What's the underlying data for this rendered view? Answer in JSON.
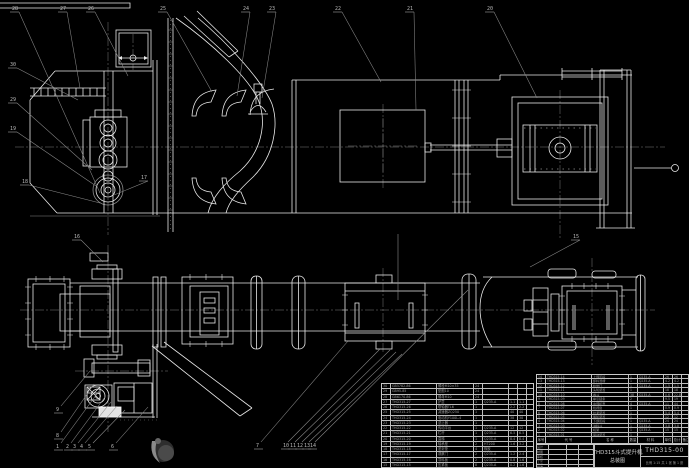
{
  "title_block": {
    "product": "THD315斗式提升机",
    "drawing_title": "总装图",
    "drawing_no": "THD315-00",
    "scale_note": "比例 1:15  共 1 张  第 1 张",
    "signature_labels": [
      "设计",
      "制图",
      "审核",
      "工艺",
      "批准"
    ]
  },
  "bom_header": [
    "序号",
    "代  号",
    "名  称",
    "数量",
    "材  料",
    "单件",
    "总计",
    "备注"
  ],
  "bom_left_rows": [
    [
      "30",
      "GB5782-86",
      "螺栓M10×35",
      "24",
      "",
      "",
      "",
      ""
    ],
    [
      "29",
      "GB95-85",
      "垫圈10",
      "24",
      "",
      "",
      "",
      ""
    ],
    [
      "28",
      "GB6170-86",
      "螺母M10",
      "24",
      "",
      "",
      "",
      ""
    ],
    [
      "27",
      "THD315-27",
      "护罩",
      "1",
      "Q235-A",
      "1.1",
      "1.1",
      ""
    ],
    [
      "26",
      "THD315-26",
      "联轴器TL6",
      "1",
      "",
      "2.2",
      "2.2",
      ""
    ],
    [
      "25",
      "THD315-25",
      "减速器ZQ250",
      "1",
      "",
      "40",
      "40",
      ""
    ],
    [
      "24",
      "THD315-24",
      "电动机Y100L-4",
      "1",
      "",
      "38",
      "38",
      ""
    ],
    [
      "23",
      "THD315-23",
      "逆止器",
      "1",
      "",
      "",
      "",
      ""
    ],
    [
      "22",
      "THD315-22",
      "传动平台",
      "1",
      "Q235-A",
      "12",
      "12",
      ""
    ],
    [
      "21",
      "THD315-21",
      "栏杆",
      "1",
      "Q235-A",
      "6.5",
      "6.5",
      ""
    ],
    [
      "20",
      "THD315-20",
      "直梯",
      "1",
      "Q235-A",
      "8.4",
      "8.4",
      ""
    ],
    [
      "19",
      "THD315-19",
      "轴承座",
      "2",
      "HT200",
      "1.6",
      "3.2",
      ""
    ],
    [
      "18",
      "THD315-18",
      "密封垫",
      "4",
      "橡胶",
      "",
      "",
      ""
    ],
    [
      "17",
      "THD315-17",
      "观察门",
      "2",
      "Q235-A",
      "1.2",
      "2.4",
      ""
    ],
    [
      "16",
      "THD315-16",
      "导料板",
      "2",
      "Q235-A",
      "0.8",
      "1.6",
      ""
    ],
    [
      "15",
      "THD315-15",
      "压紧板",
      "8",
      "Q235-A",
      "0.2",
      "1.6",
      ""
    ]
  ],
  "bom_right_rows": [
    [
      "14",
      "THD315-14",
      "上部区段",
      "1",
      "Q235-A",
      "26",
      "26",
      ""
    ],
    [
      "13",
      "THD315-13",
      "卸料溜槽",
      "1",
      "Q235-A",
      "4.2",
      "4.2",
      ""
    ],
    [
      "12",
      "THD315-12",
      "检修门",
      "1",
      "Q235-A",
      "1.5",
      "1.5",
      ""
    ],
    [
      "11",
      "THD315-11",
      "头轮装置",
      "1",
      "",
      "18",
      "18",
      ""
    ],
    [
      "10",
      "THD315-10",
      "畚斗",
      "38",
      "Q235-A",
      "0.6",
      "22.8",
      ""
    ],
    [
      "9",
      "THD315-09",
      "牵引链条",
      "2",
      "",
      "9.5",
      "19",
      ""
    ],
    [
      "8",
      "THD315-08",
      "中部机壳",
      "4",
      "Q235-A",
      "11",
      "44",
      ""
    ],
    [
      "7",
      "THD315-07",
      "检视窗",
      "1",
      "",
      "0.9",
      "0.9",
      ""
    ],
    [
      "6",
      "THD315-06",
      "拉紧装置",
      "1",
      "",
      "5.4",
      "5.4",
      ""
    ],
    [
      "5",
      "THD315-05",
      "尾轮装置",
      "1",
      "",
      "12",
      "12",
      ""
    ],
    [
      "4",
      "THD315-04",
      "下部区段",
      "1",
      "Q235-A",
      "24",
      "24",
      ""
    ],
    [
      "3",
      "THD315-03",
      "进料斗",
      "1",
      "Q235-A",
      "3.8",
      "3.8",
      ""
    ],
    [
      "2",
      "THD315-02",
      "机架",
      "1",
      "Q235-A",
      "15",
      "15",
      ""
    ],
    [
      "1",
      "THD315-01",
      "驱动装置",
      "1",
      "",
      "",
      "",
      ""
    ]
  ],
  "balloons": [
    {
      "n": "28",
      "x": 12,
      "y": 10,
      "tx": 100,
      "ty": 193
    },
    {
      "n": "27",
      "x": 60,
      "y": 10,
      "tx": 80,
      "ty": 88
    },
    {
      "n": "26",
      "x": 88,
      "y": 10,
      "tx": 128,
      "ty": 76
    },
    {
      "n": "25",
      "x": 160,
      "y": 10,
      "tx": 212,
      "ty": 92
    },
    {
      "n": "24",
      "x": 243,
      "y": 10,
      "tx": 237,
      "ty": 96
    },
    {
      "n": "23",
      "x": 269,
      "y": 10,
      "tx": 262,
      "ty": 98
    },
    {
      "n": "22",
      "x": 335,
      "y": 10,
      "tx": 381,
      "ty": 82
    },
    {
      "n": "21",
      "x": 407,
      "y": 10,
      "tx": 416,
      "ty": 110
    },
    {
      "n": "20",
      "x": 487,
      "y": 10,
      "tx": 537,
      "ty": 98
    },
    {
      "n": "30",
      "x": 10,
      "y": 66,
      "tx": 78,
      "ty": 100
    },
    {
      "n": "29",
      "x": 10,
      "y": 101,
      "tx": 92,
      "ty": 170
    },
    {
      "n": "19",
      "x": 10,
      "y": 130,
      "tx": 96,
      "ty": 186
    },
    {
      "n": "18",
      "x": 22,
      "y": 183,
      "tx": 100,
      "ty": 203
    },
    {
      "n": "17",
      "x": 141,
      "y": 179,
      "tx": 114,
      "ty": 195
    },
    {
      "n": "16",
      "x": 74,
      "y": 238,
      "tx": 103,
      "ty": 262
    },
    {
      "n": "9",
      "x": 56,
      "y": 411,
      "tx": 90,
      "ty": 371
    },
    {
      "n": "8",
      "x": 56,
      "y": 437,
      "tx": 94,
      "ty": 384
    },
    {
      "n": "1",
      "x": 56,
      "y": 448,
      "tx": 99,
      "ty": 391
    },
    {
      "n": "2",
      "x": 66,
      "y": 448,
      "tx": 105,
      "ty": 397
    },
    {
      "n": "3",
      "x": 73,
      "y": 448,
      "tx": 111,
      "ty": 402
    },
    {
      "n": "4",
      "x": 80,
      "y": 448,
      "tx": 117,
      "ty": 406
    },
    {
      "n": "5",
      "x": 88,
      "y": 448,
      "tx": 125,
      "ty": 410
    },
    {
      "n": "6",
      "x": 111,
      "y": 448,
      "tx": 148,
      "ty": 407
    },
    {
      "n": "7",
      "x": 256,
      "y": 447,
      "tx": 348,
      "ty": 341
    },
    {
      "n": "10",
      "x": 283,
      "y": 447,
      "tx": 380,
      "ty": 349
    },
    {
      "n": "11",
      "x": 290,
      "y": 447,
      "tx": 390,
      "ty": 350
    },
    {
      "n": "12",
      "x": 297,
      "y": 447,
      "tx": 396,
      "ty": 352
    },
    {
      "n": "13",
      "x": 304,
      "y": 447,
      "tx": 402,
      "ty": 354
    },
    {
      "n": "14",
      "x": 310,
      "y": 447,
      "tx": 468,
      "ty": 290
    },
    {
      "n": "15",
      "x": 573,
      "y": 238,
      "tx": 530,
      "ty": 267
    }
  ]
}
